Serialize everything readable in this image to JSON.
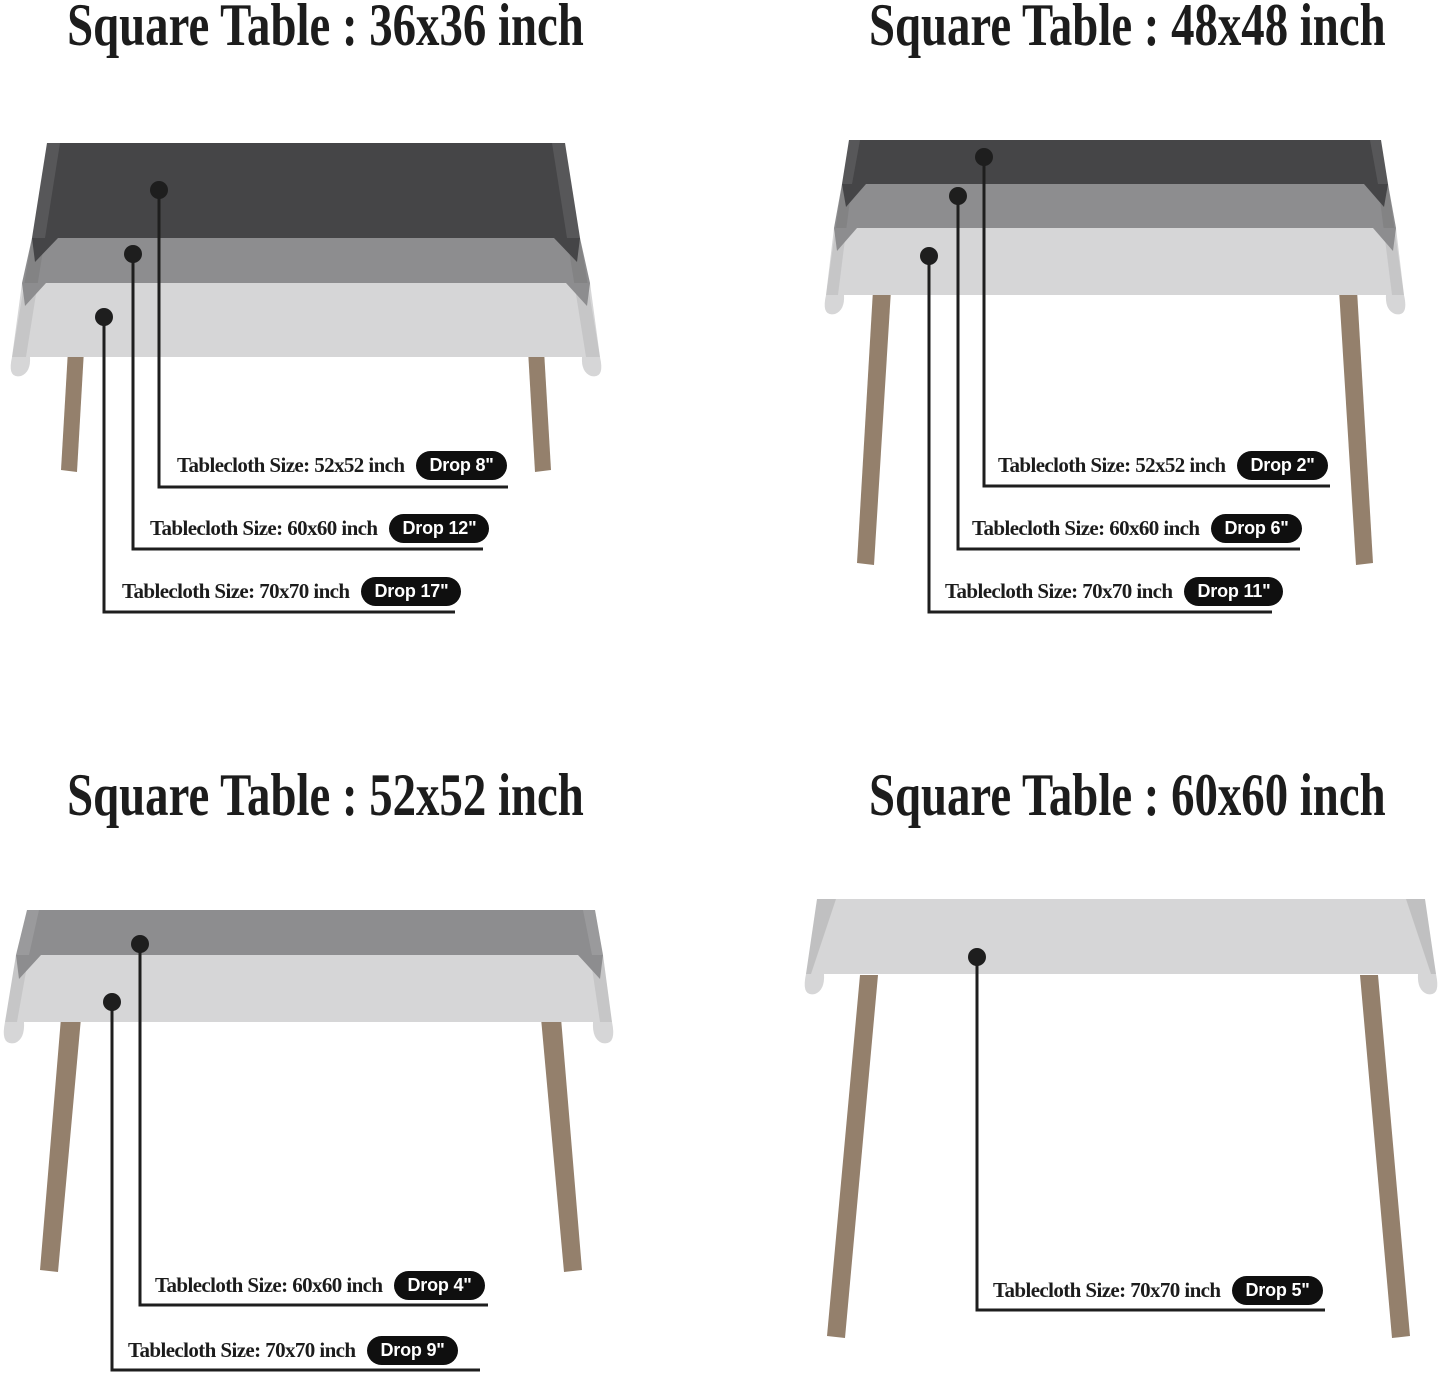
{
  "colors": {
    "background": "#ffffff",
    "cloth_dark": "#454547",
    "cloth_medium": "#8d8d8f",
    "cloth_light": "#d6d6d7",
    "table_leg": "#94806c",
    "callout_line": "#1e1e1e",
    "badge_background": "#0f0f0f",
    "badge_text": "#ffffff",
    "title_text": "#1c1c1c",
    "label_text": "#1c1c1c"
  },
  "sections": [
    {
      "title": "Square Table : 36x36 inch",
      "callouts": [
        {
          "label": "Tablecloth Size: 52x52 inch",
          "drop": "Drop 8\""
        },
        {
          "label": "Tablecloth Size: 60x60 inch",
          "drop": "Drop 12\""
        },
        {
          "label": "Tablecloth Size: 70x70 inch",
          "drop": "Drop 17\""
        }
      ]
    },
    {
      "title": "Square Table : 48x48 inch",
      "callouts": [
        {
          "label": "Tablecloth Size: 52x52 inch",
          "drop": "Drop 2\""
        },
        {
          "label": "Tablecloth Size: 60x60 inch",
          "drop": "Drop 6\""
        },
        {
          "label": "Tablecloth Size: 70x70 inch",
          "drop": "Drop 11\""
        }
      ]
    },
    {
      "title": "Square Table : 52x52 inch",
      "callouts": [
        {
          "label": "Tablecloth Size: 60x60 inch",
          "drop": "Drop 4\""
        },
        {
          "label": "Tablecloth Size: 70x70 inch",
          "drop": "Drop 9\""
        }
      ]
    },
    {
      "title": "Square Table : 60x60 inch",
      "callouts": [
        {
          "label": "Tablecloth Size: 70x70 inch",
          "drop": "Drop 5\""
        }
      ]
    }
  ]
}
